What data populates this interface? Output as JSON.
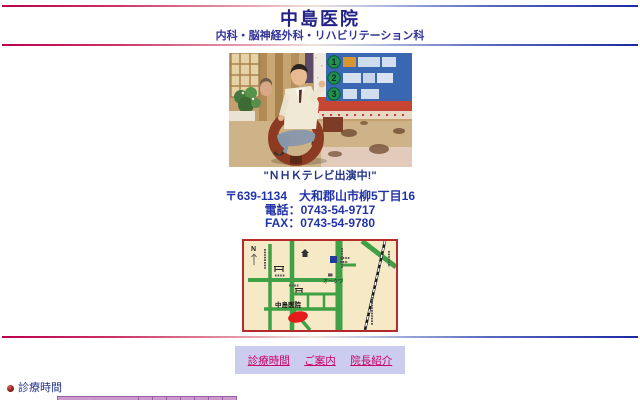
{
  "header": {
    "title": "中島医院",
    "subtitle": "内科・脳神経外科・リハビリテーション科"
  },
  "photo": {
    "caption": "\"ＮＨＫテレビ出演中!\"",
    "board": {
      "numbers": [
        "1",
        "2",
        "3"
      ]
    }
  },
  "contact": {
    "postal_address": "〒639-1134　大和郡山市柳5丁目16",
    "phone": "電話：0743-54-9717",
    "fax": "FAX：0743-54-9780"
  },
  "map": {
    "north": "N",
    "store": "オークワ",
    "clinic": "中島医院"
  },
  "nav": {
    "links": [
      {
        "label": "診療時間"
      },
      {
        "label": "ご案内"
      },
      {
        "label": "院長紹介"
      }
    ]
  },
  "schedule": {
    "heading": "診療時間",
    "columns": [
      "時間",
      "月",
      "火",
      "水",
      "木",
      "金",
      "土",
      "日"
    ]
  },
  "colors": {
    "rule_left": "#b9004e",
    "rule_right": "#1b2aa0",
    "heading_navy": "#232387",
    "address_navy": "#2233aa",
    "link_magenta": "#cc0066",
    "nav_box_bg": "#ccccee",
    "table_plum": "#cc99cc",
    "map_cream": "#f6e9c5",
    "map_road_green": "#3fa045",
    "map_marker_red": "#e51a1a",
    "map_border_red": "#b52a2a"
  }
}
